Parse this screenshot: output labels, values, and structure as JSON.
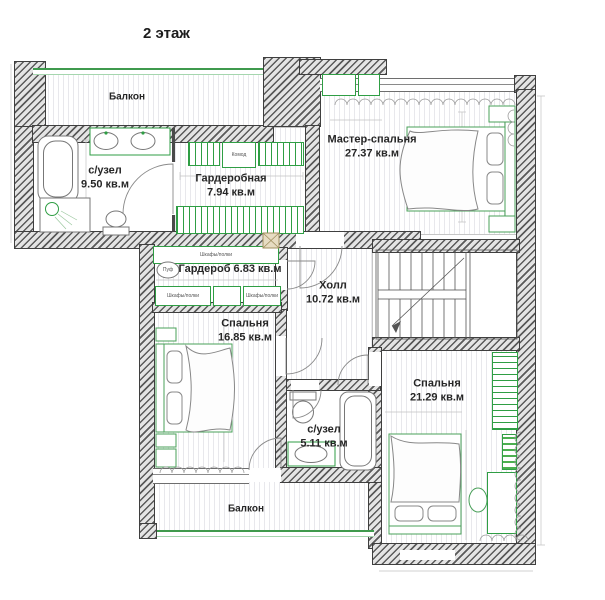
{
  "title": "2 этаж",
  "rooms": {
    "balcony_top": {
      "label": "Балкон"
    },
    "bath1": {
      "name": "с/узел",
      "area": "9.50 кв.м"
    },
    "dressing": {
      "name": "Гардеробная",
      "area": "7.94 кв.м"
    },
    "master": {
      "name": "Мастер-спальня",
      "area": "27.37 кв.м"
    },
    "wardrobe": {
      "label": "Гардероб 6.83 кв.м"
    },
    "hall": {
      "name": "Холл",
      "area": "10.72 кв.м"
    },
    "bedroom2": {
      "name": "Спальня",
      "area": "16.85 кв.м"
    },
    "bedroom3": {
      "name": "Спальня",
      "area": "21.29 кв.м"
    },
    "bath2": {
      "name": "с/узел",
      "area": "5.11 кв.м"
    },
    "balcony_bottom": {
      "label": "Балкон"
    }
  },
  "furniture": {
    "shelves": "Шкафы/полки",
    "dresser": "Комод",
    "pouf": "Пуф"
  },
  "colors": {
    "furniture_green": "#2f9e44",
    "glazing_green": "#3f9a4d",
    "wall_dark": "#4a4a4a",
    "text": "#262626"
  }
}
